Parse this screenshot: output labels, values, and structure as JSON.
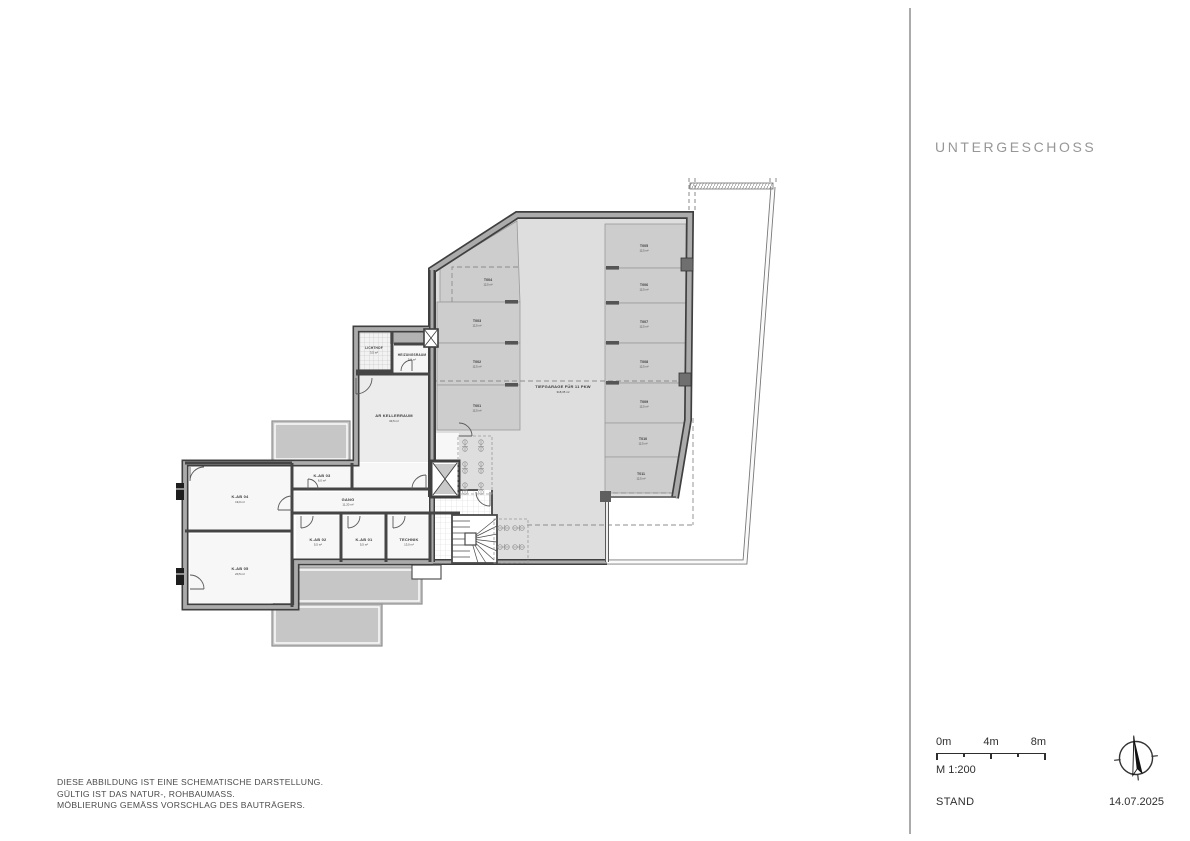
{
  "sidebar": {
    "title": "UNTERGESCHOSS",
    "scale": {
      "ticks": [
        "0m",
        "4m",
        "8m"
      ],
      "ratio": "M 1:200"
    },
    "stand_label": "STAND",
    "stand_date": "14.07.2025"
  },
  "notes": {
    "line1": "DIESE ABBILDUNG IST EINE SCHEMATISCHE DARSTELLUNG.",
    "line2": "GÜLTIG IST DAS NATUR-, ROHBAUMASS.",
    "line3": "MÖBLIERUNG GEMÄSS VORSCHLAG DES BAUTRÄGERS."
  },
  "plan": {
    "garage": {
      "label": "TIEFGARAGE FÜR 11 PKW",
      "area": "318,35 m²"
    },
    "parking": [
      {
        "id": "T001",
        "area": "12,5 m²"
      },
      {
        "id": "T002",
        "area": "12,5 m²"
      },
      {
        "id": "T003",
        "area": "12,5 m²"
      },
      {
        "id": "T004",
        "area": "12,5 m²"
      },
      {
        "id": "T005",
        "area": "12,5 m²"
      },
      {
        "id": "T006",
        "area": "12,5 m²"
      },
      {
        "id": "T007",
        "area": "12,5 m²"
      },
      {
        "id": "T008",
        "area": "12,5 m²"
      },
      {
        "id": "T009",
        "area": "12,5 m²"
      },
      {
        "id": "T010",
        "area": "12,5 m²"
      },
      {
        "id": "T011",
        "area": "12,5 m²"
      }
    ],
    "rooms": {
      "lichthof": {
        "label": "LICHTHOF",
        "area": "3,5 m²"
      },
      "heizung": {
        "label": "HEIZUNGSRAUM",
        "area": "5,0 m²"
      },
      "ar_keller": {
        "label": "AR KELLERRAUM",
        "area": "33,5 m²"
      },
      "kab03": {
        "label": "K-AB 03",
        "area": "6,0 m²"
      },
      "gang": {
        "label": "GANG",
        "area": "11,20 m²"
      },
      "kab04": {
        "label": "K-AB 04",
        "area": "19,0 m²"
      },
      "kab05": {
        "label": "K-AB 05",
        "area": "20,5 m²"
      },
      "kab02": {
        "label": "K-AB 02",
        "area": "5,5 m²"
      },
      "kab01": {
        "label": "K-AB 01",
        "area": "5,5 m²"
      },
      "technik": {
        "label": "TECHNIK",
        "area": "13,0 m²"
      }
    }
  },
  "colors": {
    "wall": "#3f3f3f",
    "wall_fill": "#aaaaaa",
    "garage_floor": "#dedede",
    "stall_fill": "#cdcdcd",
    "patio_fill": "#c9c9c9",
    "title_gray": "#979797"
  }
}
